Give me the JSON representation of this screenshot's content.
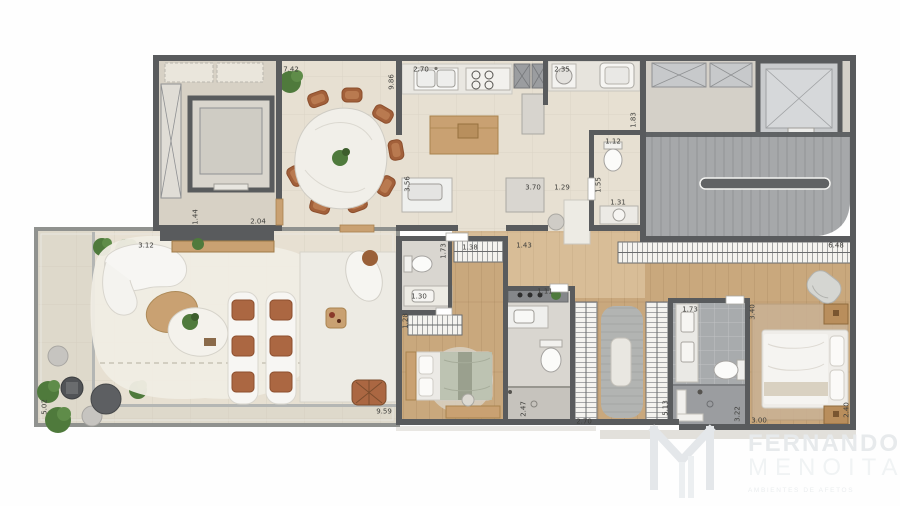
{
  "title": "apartment-floor-plan",
  "dims": {
    "dining_top": "7.42",
    "dining_right": "9.86",
    "kitchen_top": "2.70",
    "service_top": "2.35",
    "service_right": "1.83",
    "wc_top": "1.12",
    "kitchen_left": "3.56",
    "kitchen_bottom_a": "3.70",
    "kitchen_bottom_b": "1.29",
    "wc_left": "1.55",
    "wc_bottom": "1.31",
    "lobby_side": "1.44",
    "sideboard": "2.04",
    "living_top": "3.12",
    "terrace_left": "5.02",
    "terrace_bottom": "9.59",
    "bed1_closet_depth": "1.73",
    "bed1_closet": "1.38",
    "bed1_top": "1.43",
    "lavabo": "1.30",
    "bed1_closet_b": "1.28",
    "bath2_sink": "1.11",
    "bath2_left": "2.47",
    "bath2_bottom": "2.70",
    "closet_side": "5.13",
    "mbath_top": "1.73",
    "mbath_right": "3.40",
    "mbath_bottom": "3.22",
    "mbed_bottom": "3.00",
    "wardrobe_top": "6.48",
    "mbed_right": "2.40"
  },
  "brand": {
    "line1": "FERNANDO",
    "line2": "MENOITA",
    "tagline": "AMBIENTES DE AFETOS"
  },
  "colors": {
    "wall": "#595b5d",
    "floor_beige": "#e7e0d2",
    "floor_terrace": "#ded9cb",
    "floor_lobby": "#d7d1c5",
    "wood": "#c9a87d",
    "wood_light": "#d8bd97",
    "bath_light": "#d9d6d0",
    "tile_gray": "#a8abad",
    "stair_gray": "#a6a8aa",
    "rug_cream": "#f0ede4",
    "marble": "#edebe4",
    "terracotta": "#ab6742",
    "wood_furniture": "#c9a172",
    "plant_green": "#4f7a3c",
    "dim_text": "#3f3f3c",
    "logo_gray": "#e6e9ec"
  }
}
